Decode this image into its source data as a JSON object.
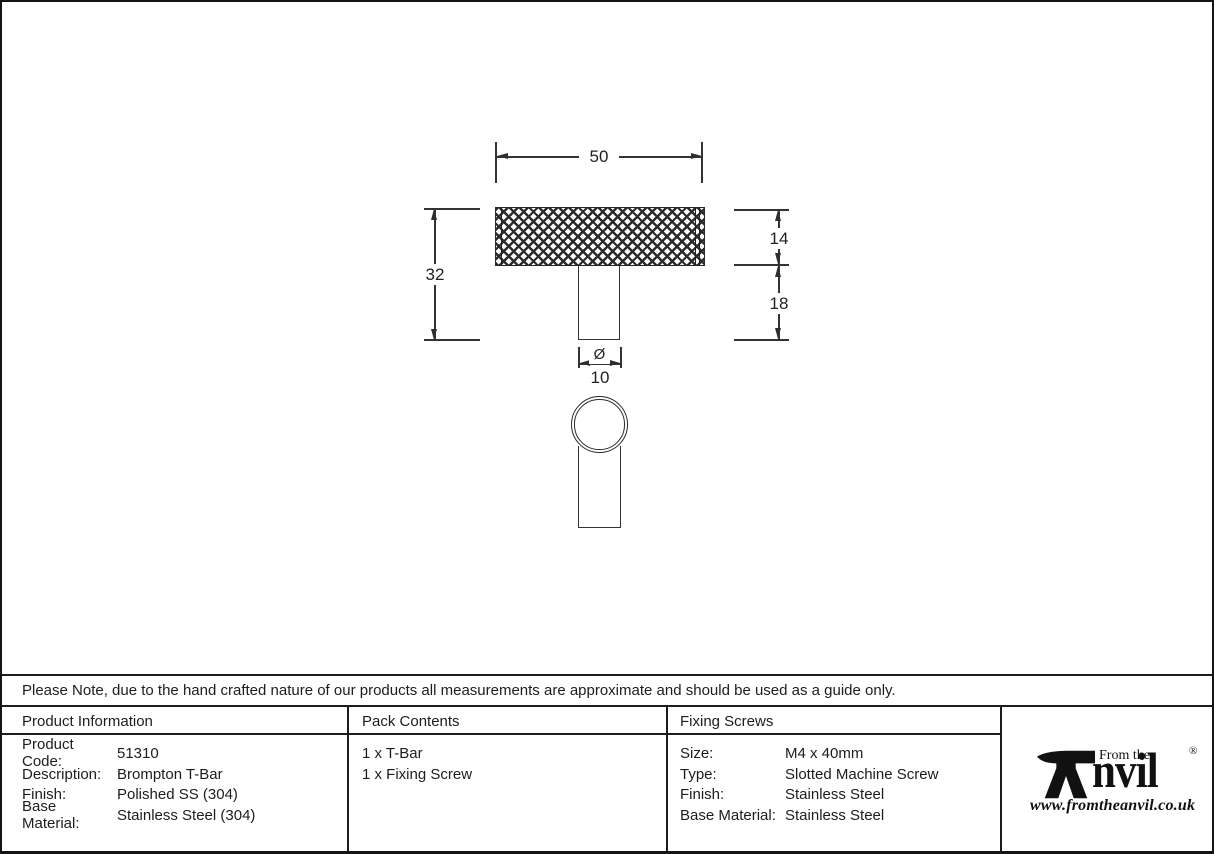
{
  "drawing": {
    "dim_width": "50",
    "dim_total_height": "32",
    "dim_bar_height": "14",
    "dim_stem_height": "18",
    "dim_diameter_symbol": "Ø",
    "dim_diameter": "10"
  },
  "note": "Please Note, due to the hand crafted nature of our products all measurements are approximate and should be used as a guide only.",
  "product_information": {
    "header": "Product Information",
    "rows": [
      {
        "label": "Product Code:",
        "value": "51310"
      },
      {
        "label": "Description:",
        "value": "Brompton T-Bar"
      },
      {
        "label": "Finish:",
        "value": "Polished SS (304)"
      },
      {
        "label": "Base Material:",
        "value": "Stainless Steel (304)"
      }
    ]
  },
  "pack_contents": {
    "header": "Pack Contents",
    "items": [
      "1 x T-Bar",
      "1 x Fixing Screw"
    ]
  },
  "fixing_screws": {
    "header": "Fixing Screws",
    "rows": [
      {
        "label": "Size:",
        "value": "M4 x 40mm"
      },
      {
        "label": "Type:",
        "value": "Slotted Machine Screw"
      },
      {
        "label": "Finish:",
        "value": "Stainless Steel"
      },
      {
        "label": "Base Material:",
        "value": "Stainless Steel"
      }
    ]
  },
  "brand": {
    "from_the": "From the",
    "anvil_text": "nvil",
    "registered": "®",
    "website": "www.fromtheanvil.co.uk",
    "ink_color": "#111111"
  }
}
